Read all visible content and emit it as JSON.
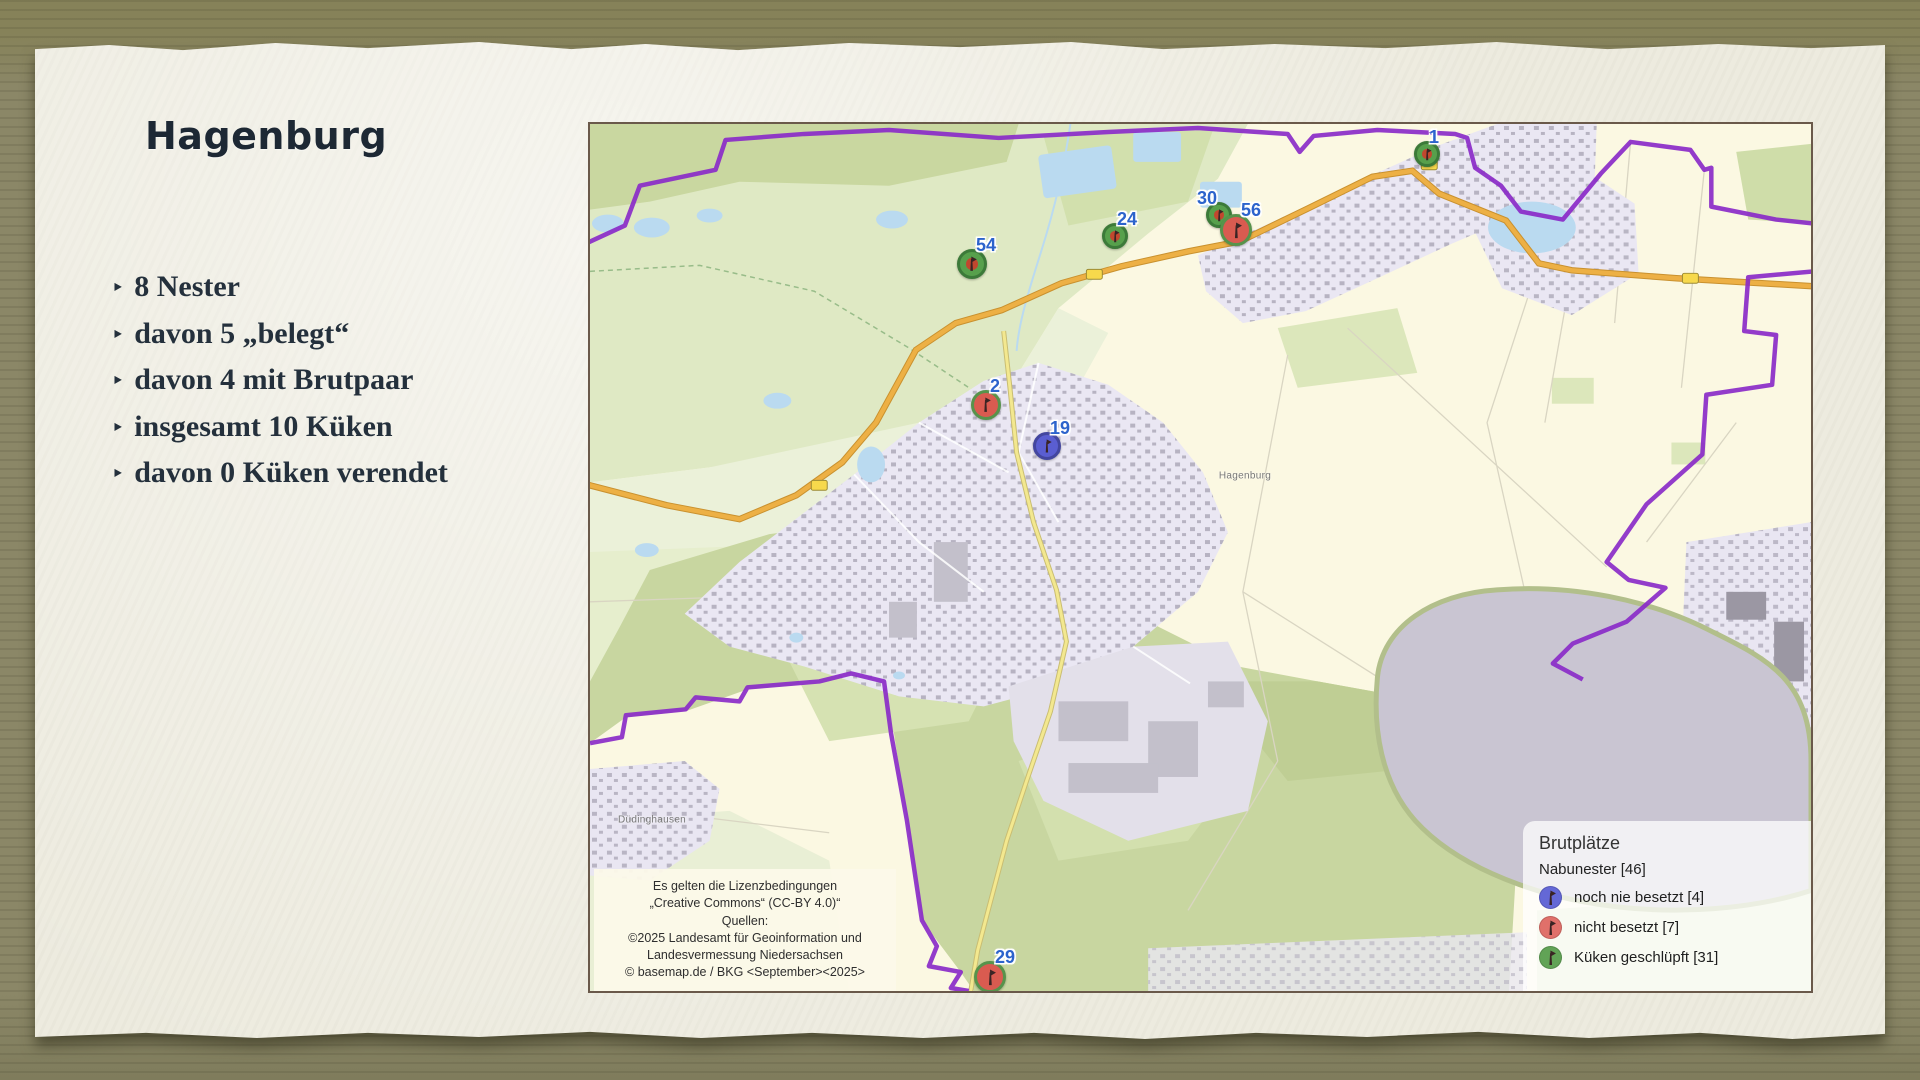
{
  "slide": {
    "title": "Hagenburg",
    "bullet_glyph": "‣",
    "bullets": [
      "8 Nester",
      "davon 5 „belegt“",
      "davon 4 mit Brutpaar",
      "insgesamt 10 Küken",
      "davon 0 Küken verendet"
    ]
  },
  "map": {
    "place_labels": [
      {
        "text": "Hagenburg",
        "x": 655,
        "y": 352
      },
      {
        "text": "Düdinghausen",
        "x": 62,
        "y": 696
      }
    ],
    "license_lines": [
      "Es gelten die Lizenzbedingungen",
      "„Creative Commons“ (CC-BY 4.0)“",
      "Quellen:",
      "©2025 Landesamt für Geoinformation und",
      "Landesvermessung Niedersachsen",
      "© basemap.de / BKG <September><2025>"
    ],
    "legend": {
      "title": "Brutplätze",
      "subtitle": "Nabunester [46]",
      "items": [
        {
          "label": "noch nie besetzt [4]",
          "type": "never",
          "color": "#6468d6"
        },
        {
          "label": "nicht besetzt [7]",
          "type": "empty",
          "color": "#e0706a"
        },
        {
          "label": "Küken geschlüpft [31]",
          "type": "hatched",
          "color": "#61a356"
        }
      ]
    },
    "markers": [
      {
        "label": "1",
        "type": "hatched",
        "x": 837,
        "y": 30,
        "r": 13
      },
      {
        "label": "30",
        "type": "hatched",
        "x": 629,
        "y": 91,
        "r": 13,
        "label_side": "left"
      },
      {
        "label": "56",
        "type": "empty",
        "x": 646,
        "y": 106,
        "r": 16
      },
      {
        "label": "24",
        "type": "hatched",
        "x": 525,
        "y": 112,
        "r": 13
      },
      {
        "label": "54",
        "type": "hatched",
        "x": 382,
        "y": 140,
        "r": 15
      },
      {
        "label": "2",
        "type": "empty",
        "x": 396,
        "y": 281,
        "r": 15
      },
      {
        "label": "19",
        "type": "never",
        "x": 457,
        "y": 322,
        "r": 14
      },
      {
        "label": "29",
        "type": "empty",
        "x": 400,
        "y": 853,
        "r": 16
      }
    ],
    "colors": {
      "boundary_purple": "#8a2bc8",
      "marker_number_blue": "#2c63cc",
      "marker_green": "#57a04c",
      "marker_red": "#d95b50",
      "marker_blue": "#5a5ed1"
    }
  }
}
